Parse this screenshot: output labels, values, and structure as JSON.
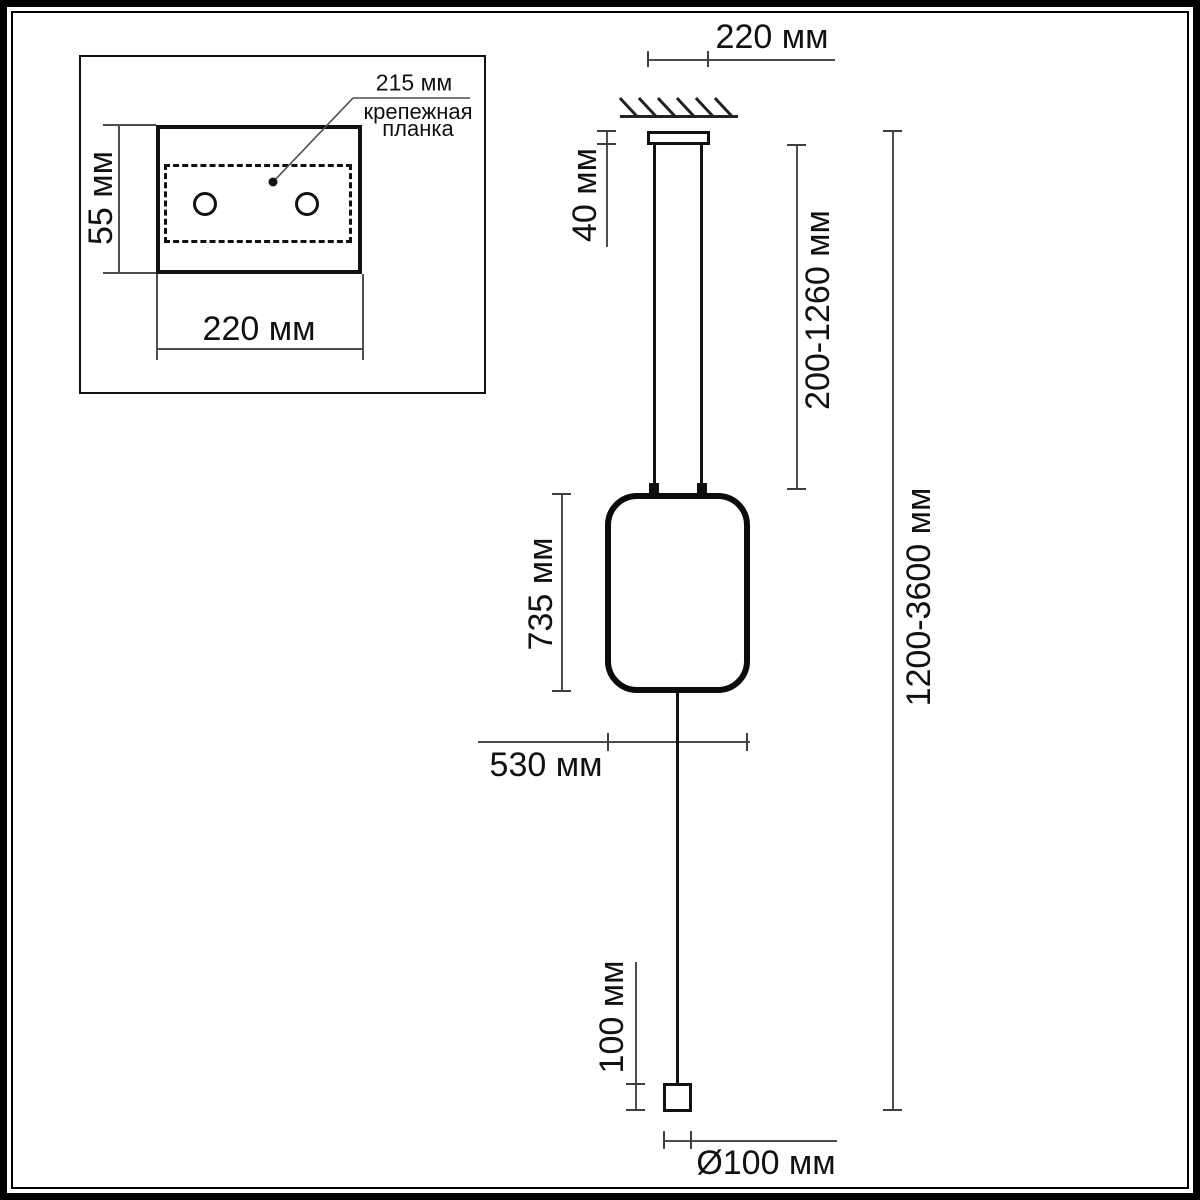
{
  "inset": {
    "callout_value": "215 мм",
    "callout_line1": "крепежная",
    "callout_line2": "планка",
    "plate_height": "55 мм",
    "plate_width": "220 мм"
  },
  "main": {
    "canopy_width": "220 мм",
    "canopy_height": "40 мм",
    "suspension_range": "200-1260 мм",
    "total_range": "1200-3600 мм",
    "shade_height": "735 мм",
    "shade_width": "530 мм",
    "anchor_height": "100 мм",
    "anchor_diameter": "Ø100 мм"
  },
  "colors": {
    "object_line": "#111111",
    "dimension_line": "#4d4d4d",
    "background": "#ffffff"
  }
}
